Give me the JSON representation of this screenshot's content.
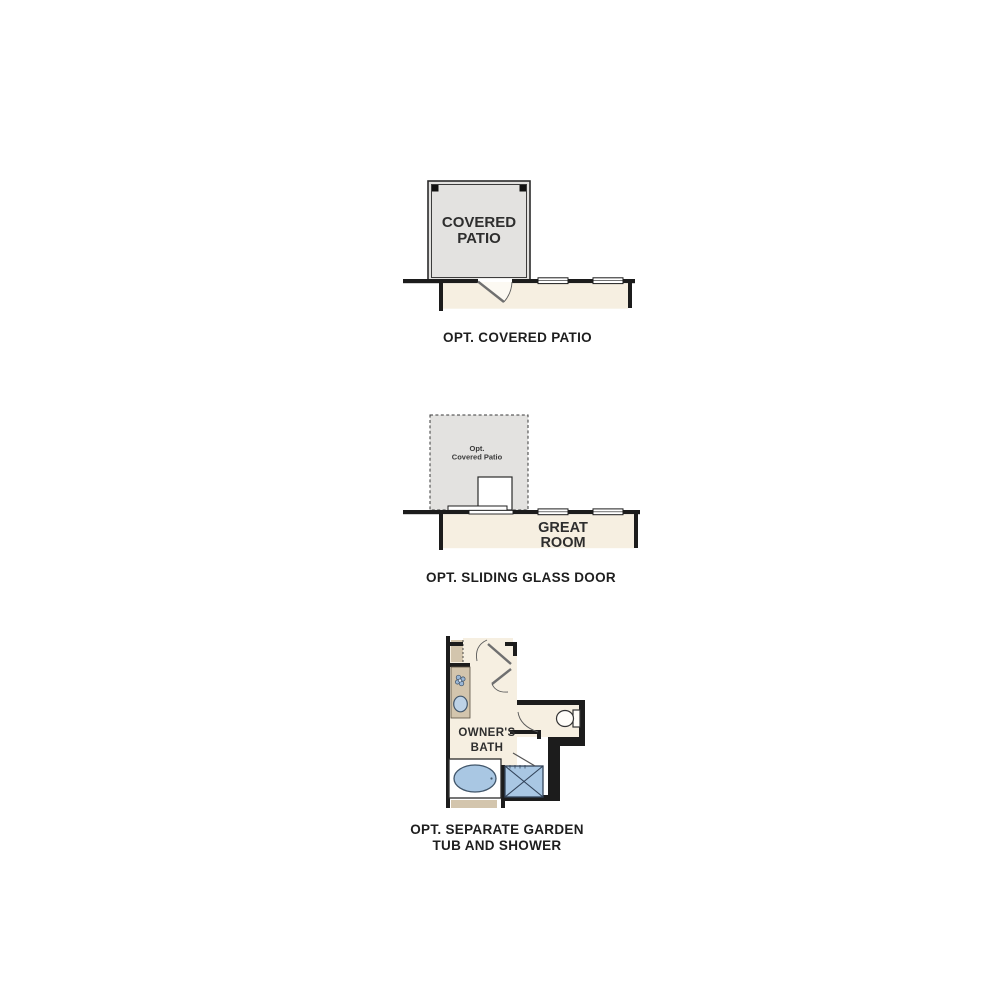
{
  "page": {
    "background": "#ffffff",
    "description_labels_visible": true
  },
  "colors": {
    "wall": "#1c1c1c",
    "patio_fill": "#e3e2e0",
    "interior_fill": "#f6efe1",
    "fixture_fill": "#a9c7e3",
    "fixture_stroke": "#41566b",
    "cabinet_tan": "#d3c5ad",
    "door_gray": "#6f6f6f",
    "caption_text": "#1e1e1e",
    "label_text": "#2e2e2e"
  },
  "icons": {
    "door": "door-swing-icon",
    "window": "window-symbol",
    "sliding_door": "sliding-door-symbol",
    "sink": "sink-icon",
    "plant": "plant-icon",
    "toilet": "toilet-icon",
    "bathtub": "bathtub-icon",
    "shower": "shower-icon"
  },
  "figures": [
    {
      "name": "opt-covered-patio",
      "caption": "OPT. COVERED PATIO",
      "room_label_lines": [
        "COVERED",
        "PATIO"
      ]
    },
    {
      "name": "opt-sliding-glass-door",
      "caption": "OPT. SLIDING GLASS DOOR",
      "patio_label_lines": [
        "Opt.",
        "Covered Patio"
      ],
      "room_label_lines": [
        "GREAT",
        "ROOM"
      ]
    },
    {
      "name": "opt-separate-garden-tub-and-shower",
      "caption_lines": [
        "OPT. SEPARATE GARDEN",
        "TUB AND SHOWER"
      ],
      "room_label_lines": [
        "OWNER'S",
        "BATH"
      ]
    }
  ]
}
